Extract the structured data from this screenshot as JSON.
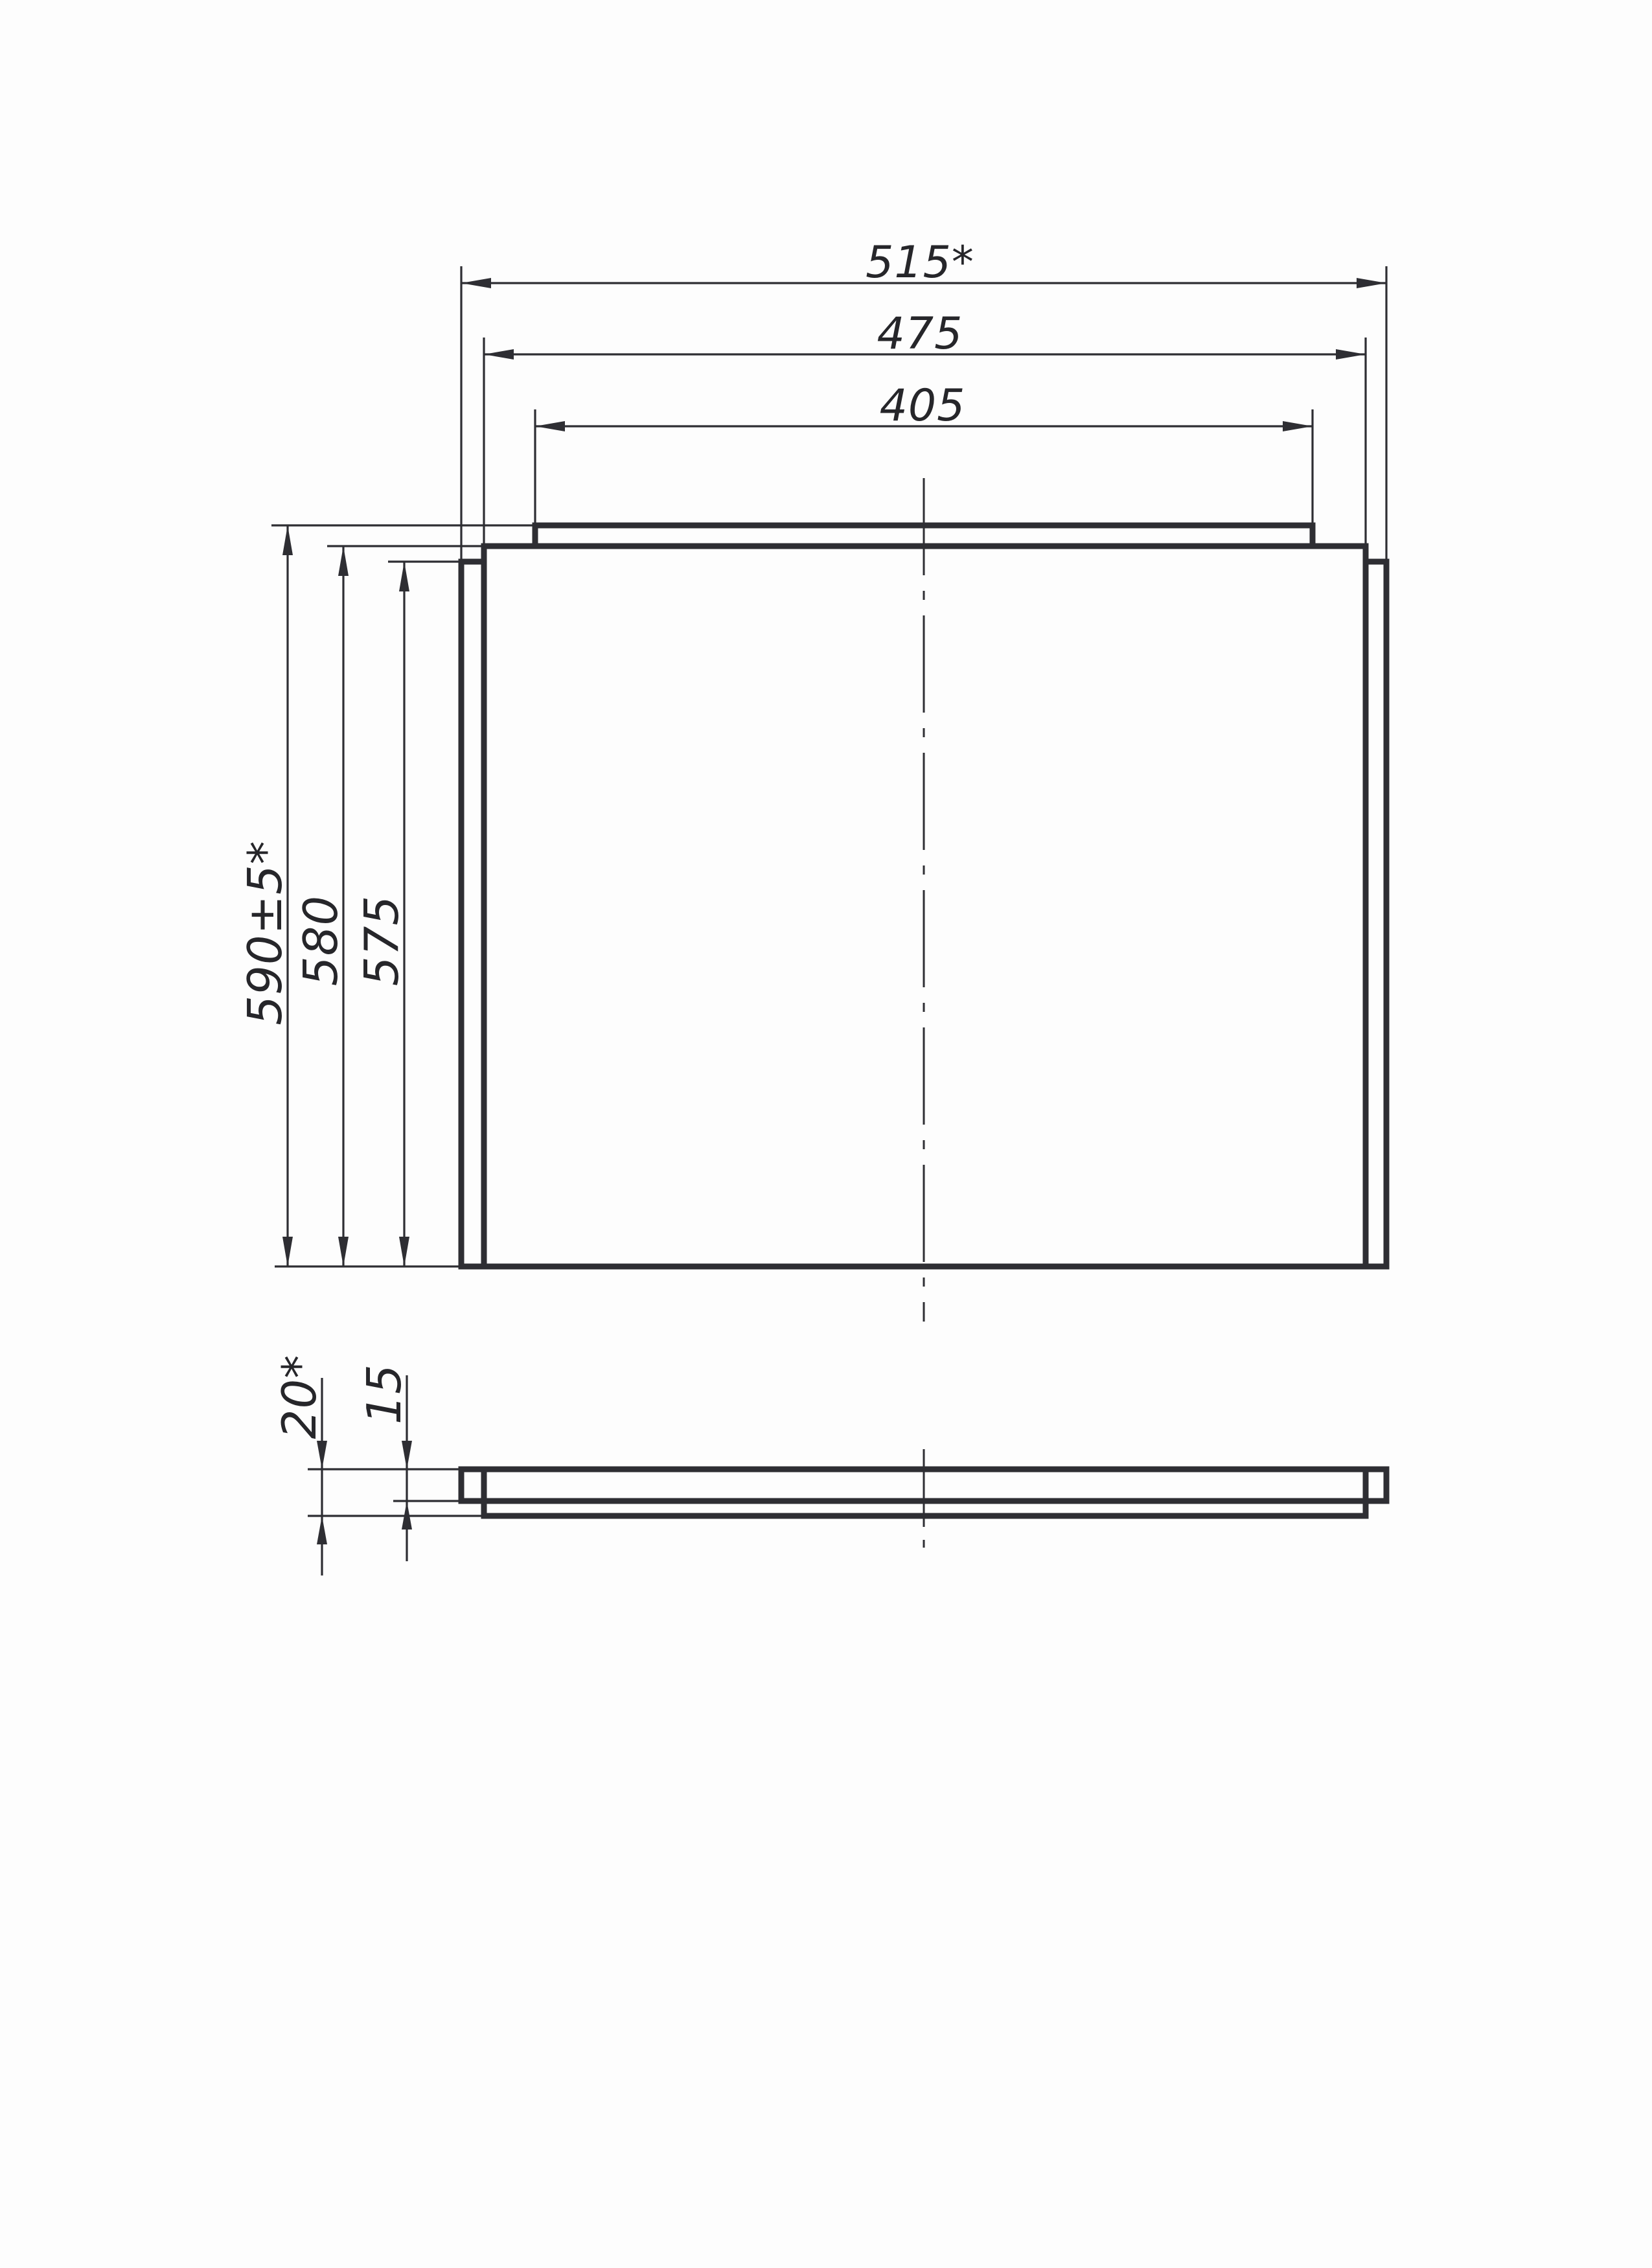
{
  "colors": {
    "ink": "#2e2e33",
    "paper": "#fdfdfd"
  },
  "front_view": {
    "horizontal_dims": [
      {
        "id": "width-overall",
        "label": "515*"
      },
      {
        "id": "width-face",
        "label": "475"
      },
      {
        "id": "width-tab",
        "label": "405"
      }
    ],
    "vertical_dims": [
      {
        "id": "height-overall",
        "label": "590±5*"
      },
      {
        "id": "height-face",
        "label": "580"
      },
      {
        "id": "height-body",
        "label": "575"
      }
    ]
  },
  "profile_view": {
    "thickness_dims": [
      {
        "id": "thickness-overall",
        "label": "20*"
      },
      {
        "id": "thickness-sheet",
        "label": "15"
      }
    ]
  }
}
